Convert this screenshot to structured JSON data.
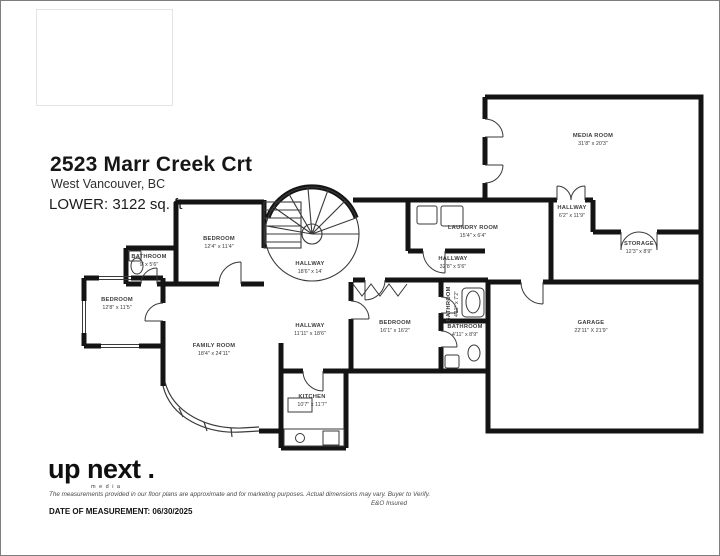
{
  "header": {
    "title": "2523 Marr Creek Crt",
    "subtitle": "West Vancouver, BC",
    "floor_label": "LOWER: 3122 sq. ft"
  },
  "rooms": [
    {
      "name": "MEDIA ROOM",
      "dims": "31'8\" x 20'3\""
    },
    {
      "name": "HALLWAY",
      "dims": "6'2\" x 11'9\""
    },
    {
      "name": "STORAGE",
      "dims": "12'3\" x 8'9\""
    },
    {
      "name": "LAUNDRY ROOM",
      "dims": "15'4\" x 6'4\""
    },
    {
      "name": "HALLWAY",
      "dims": "32'8\" x 5'6\""
    },
    {
      "name": "BEDROOM",
      "dims": "12'4\" x 11'4\""
    },
    {
      "name": "BATHROOM",
      "dims": "9' x 5'6\""
    },
    {
      "name": "BEDROOM",
      "dims": "12'8\" x 11'5\""
    },
    {
      "name": "HALLWAY",
      "dims": "18'6\" x 14'"
    },
    {
      "name": "FAMILY ROOM",
      "dims": "18'4\" x 24'11\""
    },
    {
      "name": "HALLWAY",
      "dims": "11'11\" x 18'6\""
    },
    {
      "name": "BEDROOM",
      "dims": "16'1\" x 16'2\""
    },
    {
      "name": "BATHROOM",
      "dims": "4'11\" x 7'2\""
    },
    {
      "name": "BATHROOM",
      "dims": "4'11\" x 8'9\""
    },
    {
      "name": "GARAGE",
      "dims": "22'11\" X 21'9\""
    },
    {
      "name": "KITCHEN",
      "dims": "10'7\" x 11'7\""
    }
  ],
  "footer": {
    "logo_text": "up next .",
    "logo_sub": "media",
    "disclaimer": "The measurements provided in our floor plans are approximate and for marketing purposes. Actual dimensions may vary. Buyer to Verify.",
    "insured": "E&O Insured",
    "date_label": "DATE OF MEASUREMENT: 06/30/2025"
  },
  "colors": {
    "wall": "#141414",
    "thin_line": "#3a3a3a",
    "label_text": "#3d3d3d",
    "background": "#ffffff"
  }
}
